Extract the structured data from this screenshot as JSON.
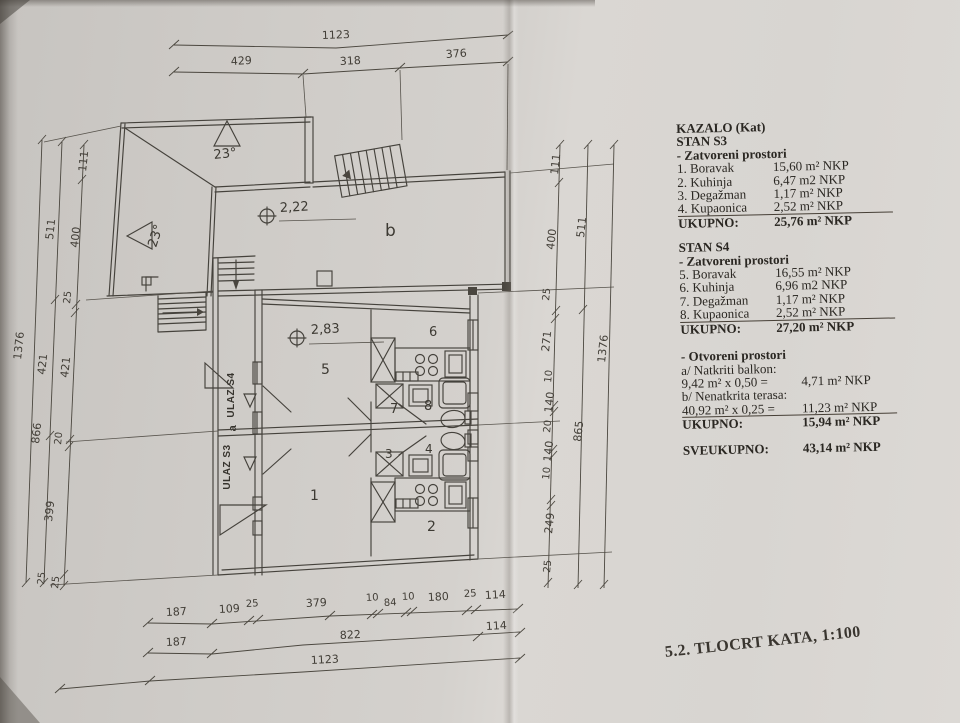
{
  "legend": {
    "header": "KAZALO (Kat)",
    "s3": {
      "title": "STAN S3",
      "subtitle": "- Zatvoreni prostori",
      "rows": [
        {
          "label": "1. Boravak",
          "value": "15,60 m² NKP"
        },
        {
          "label": "2. Kuhinja",
          "value": "6,47 m2 NKP"
        },
        {
          "label": "3. Degažman",
          "value": "1,17 m² NKP"
        },
        {
          "label": "4. Kupaonica",
          "value": "2,52 m² NKP"
        }
      ],
      "total_label": "UKUPNO:",
      "total_value": "25,76 m² NKP"
    },
    "s4": {
      "title": "STAN S4",
      "subtitle": "- Zatvoreni prostori",
      "rows": [
        {
          "label": "5. Boravak",
          "value": "16,55 m² NKP"
        },
        {
          "label": "6. Kuhinja",
          "value": "6,96 m2 NKP"
        },
        {
          "label": "7. Degažman",
          "value": "1,17 m² NKP"
        },
        {
          "label": "8. Kupaonica",
          "value": "2,52 m² NKP"
        }
      ],
      "total_label": "UKUPNO:",
      "total_value": "27,20 m² NKP"
    },
    "open": {
      "subtitle": "- Otvoreni prostori",
      "rows": [
        {
          "label": "a/ Natkriti balkon:",
          "value": ""
        },
        {
          "label": "9,42 m² x 0,50 =",
          "value": "4,71 m² NKP"
        },
        {
          "label": "b/ Nenatkrita terasa:",
          "value": ""
        },
        {
          "label": "40,92 m² x 0,25 =",
          "value": "11,23 m² NKP"
        }
      ],
      "total_label": "UKUPNO:",
      "total_value": "15,94 m² NKP"
    },
    "grand": {
      "label": "SVEUKUPNO:",
      "value": "43,14 m² NKP"
    }
  },
  "footer": {
    "title": "5.2. TLOCRT KATA, 1:100"
  },
  "plan": {
    "room1": "1",
    "room2": "2",
    "room3": "3",
    "room4": "4",
    "room5": "5",
    "room6": "6",
    "room7": "7",
    "room8": "8",
    "terrace": "b",
    "corridor": "a",
    "ulaz_s3": "ULAZ S3",
    "ulaz_s4": "ULAZ S4",
    "height_terrace": "2,22",
    "height_room": "2,83",
    "slope_top": "23°",
    "slope_left": "23°"
  },
  "dims": {
    "top_total": "1123",
    "top_row": [
      "429",
      "318",
      "376"
    ],
    "left": [
      "111",
      "511",
      "400",
      "25",
      "1376",
      "421",
      "421",
      "866",
      "20",
      "399",
      "25",
      "25"
    ],
    "right": [
      "111",
      "511",
      "400",
      "25",
      "271",
      "1376",
      "10",
      "140",
      "20",
      "865",
      "140",
      "10",
      "249",
      "25"
    ],
    "bottom1": [
      "187",
      "109",
      "25",
      "379",
      "10",
      "84",
      "10",
      "180",
      "25",
      "114"
    ],
    "bottom2": [
      "187",
      "822",
      "114"
    ],
    "bottom3": "1123"
  },
  "colors": {
    "paper": "#d4d1cd",
    "ink": "#45423c",
    "text": "#2a2722"
  }
}
